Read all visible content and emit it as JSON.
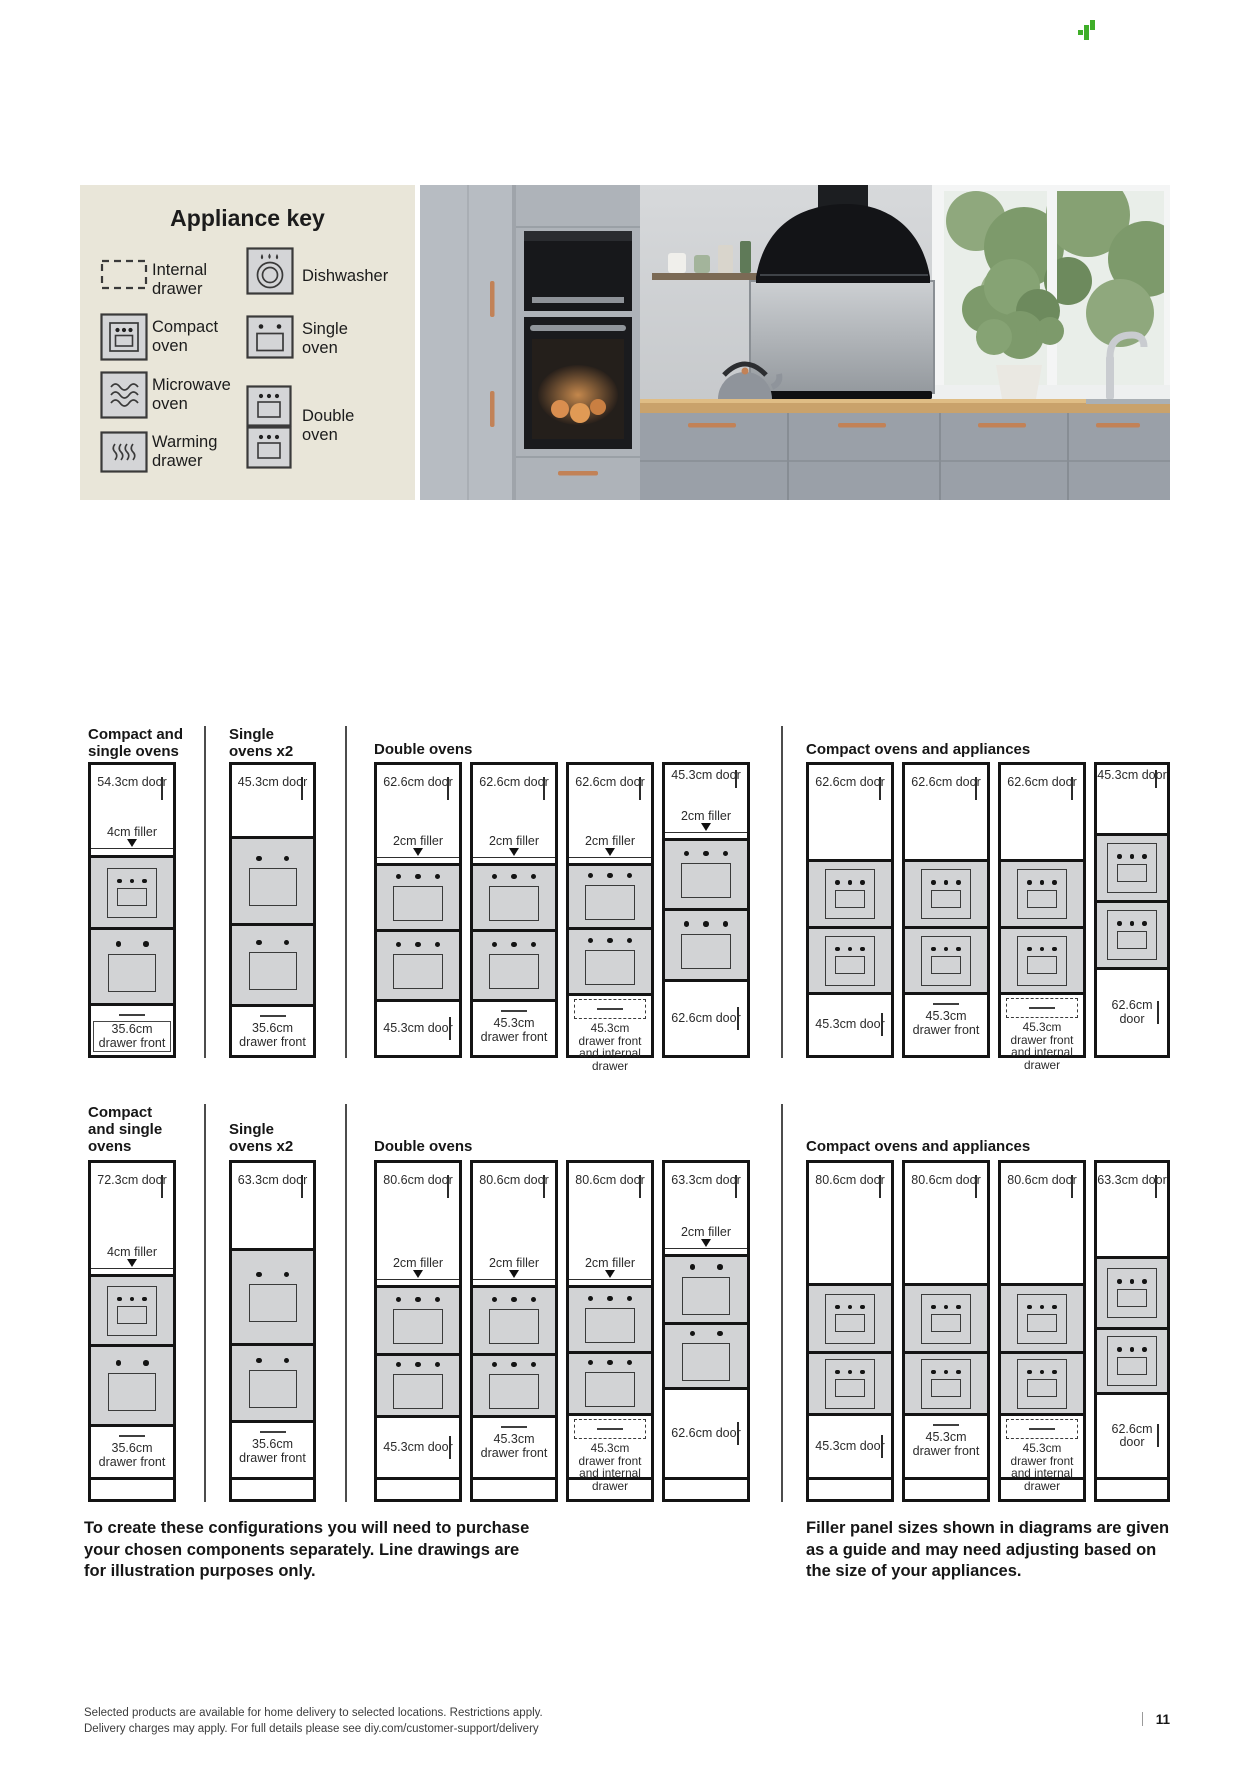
{
  "header": {
    "brand_logo": "green-pixel-plant-icon"
  },
  "appliance_key": {
    "title": "Appliance key",
    "items": [
      {
        "icon": "internal-drawer-icon",
        "label": "Internal drawer"
      },
      {
        "icon": "dishwasher-icon",
        "label": "Dishwasher"
      },
      {
        "icon": "compact-oven-icon",
        "label": "Compact oven"
      },
      {
        "icon": "single-oven-icon",
        "label": "Single oven"
      },
      {
        "icon": "microwave-oven-icon",
        "label": "Microwave oven"
      },
      {
        "icon": "double-oven-icon",
        "label": "Double oven"
      },
      {
        "icon": "warming-drawer-icon",
        "label": "Warming drawer"
      }
    ]
  },
  "rows": [
    {
      "groups": [
        {
          "title": "Compact and single ovens",
          "columns": [
            {
              "door": "54.3cm door",
              "filler": "4cm filler",
              "ovens": [
                "compact oven",
                "single oven"
              ],
              "bottom": "35.6cm drawer front"
            }
          ]
        },
        {
          "title": "Single ovens x2",
          "columns": [
            {
              "door": "45.3cm door",
              "ovens": [
                "single oven",
                "single oven"
              ],
              "bottom": "35.6cm drawer front"
            }
          ]
        },
        {
          "title": "Double ovens",
          "columns": [
            {
              "door": "62.6cm door",
              "filler": "2cm filler",
              "ovens": [
                "double oven"
              ],
              "bottom": "45.3cm door"
            },
            {
              "door": "62.6cm door",
              "filler": "2cm filler",
              "ovens": [
                "double oven"
              ],
              "bottom": "45.3cm drawer front"
            },
            {
              "door": "62.6cm door",
              "filler": "2cm filler",
              "ovens": [
                "double oven"
              ],
              "bottom": "45.3cm drawer front and internal drawer"
            },
            {
              "door": "45.3cm door",
              "filler": "2cm filler",
              "ovens": [
                "double oven"
              ],
              "bottom": "62.6cm door"
            }
          ]
        },
        {
          "title": "Compact ovens and appliances",
          "columns": [
            {
              "door": "62.6cm door",
              "ovens": [
                "compact oven",
                "compact oven"
              ],
              "bottom": "45.3cm door"
            },
            {
              "door": "62.6cm door",
              "ovens": [
                "compact oven",
                "compact oven"
              ],
              "bottom": "45.3cm drawer front"
            },
            {
              "door": "62.6cm door",
              "ovens": [
                "compact oven",
                "compact oven"
              ],
              "bottom": "45.3cm drawer front and internal drawer"
            },
            {
              "door": "45.3cm door",
              "ovens": [
                "compact oven",
                "compact oven"
              ],
              "bottom": "62.6cm door"
            }
          ]
        }
      ]
    },
    {
      "groups": [
        {
          "title": "Compact and single ovens",
          "columns": [
            {
              "door": "72.3cm door",
              "filler": "4cm filler",
              "ovens": [
                "compact oven",
                "single oven"
              ],
              "bottom": "35.6cm drawer front"
            }
          ]
        },
        {
          "title": "Single ovens x2",
          "columns": [
            {
              "door": "63.3cm door",
              "ovens": [
                "single oven",
                "single oven"
              ],
              "bottom": "35.6cm drawer front"
            }
          ]
        },
        {
          "title": "Double ovens",
          "columns": [
            {
              "door": "80.6cm door",
              "filler": "2cm filler",
              "ovens": [
                "double oven"
              ],
              "bottom": "45.3cm door"
            },
            {
              "door": "80.6cm door",
              "filler": "2cm filler",
              "ovens": [
                "double oven"
              ],
              "bottom": "45.3cm drawer front"
            },
            {
              "door": "80.6cm door",
              "filler": "2cm filler",
              "ovens": [
                "double oven"
              ],
              "bottom": "45.3cm drawer front and internal drawer"
            },
            {
              "door": "63.3cm door",
              "filler": "2cm filler",
              "ovens": [
                "single oven",
                "single oven"
              ],
              "bottom": "62.6cm door"
            }
          ]
        },
        {
          "title": "Compact ovens and appliances",
          "columns": [
            {
              "door": "80.6cm door",
              "ovens": [
                "compact oven",
                "compact oven"
              ],
              "bottom": "45.3cm door"
            },
            {
              "door": "80.6cm door",
              "ovens": [
                "compact oven",
                "compact oven"
              ],
              "bottom": "45.3cm drawer front"
            },
            {
              "door": "80.6cm door",
              "ovens": [
                "compact oven",
                "compact oven"
              ],
              "bottom": "45.3cm drawer front and internal drawer"
            },
            {
              "door": "63.3cm door",
              "ovens": [
                "compact oven",
                "compact oven"
              ],
              "bottom": "62.6cm door"
            }
          ]
        }
      ]
    }
  ],
  "notes": {
    "left": "To create these configurations you will need to purchase your chosen components separately. Line drawings are for illustration purposes only.",
    "right": "Filler panel sizes shown in diagrams are given as a guide and may need adjusting based on the size of your appliances."
  },
  "footer": {
    "line1": "Selected products are available for home delivery to selected locations. Restrictions apply.",
    "line2": "Delivery charges may apply. For full details please see diy.com/customer-support/delivery",
    "page_number": "11"
  }
}
